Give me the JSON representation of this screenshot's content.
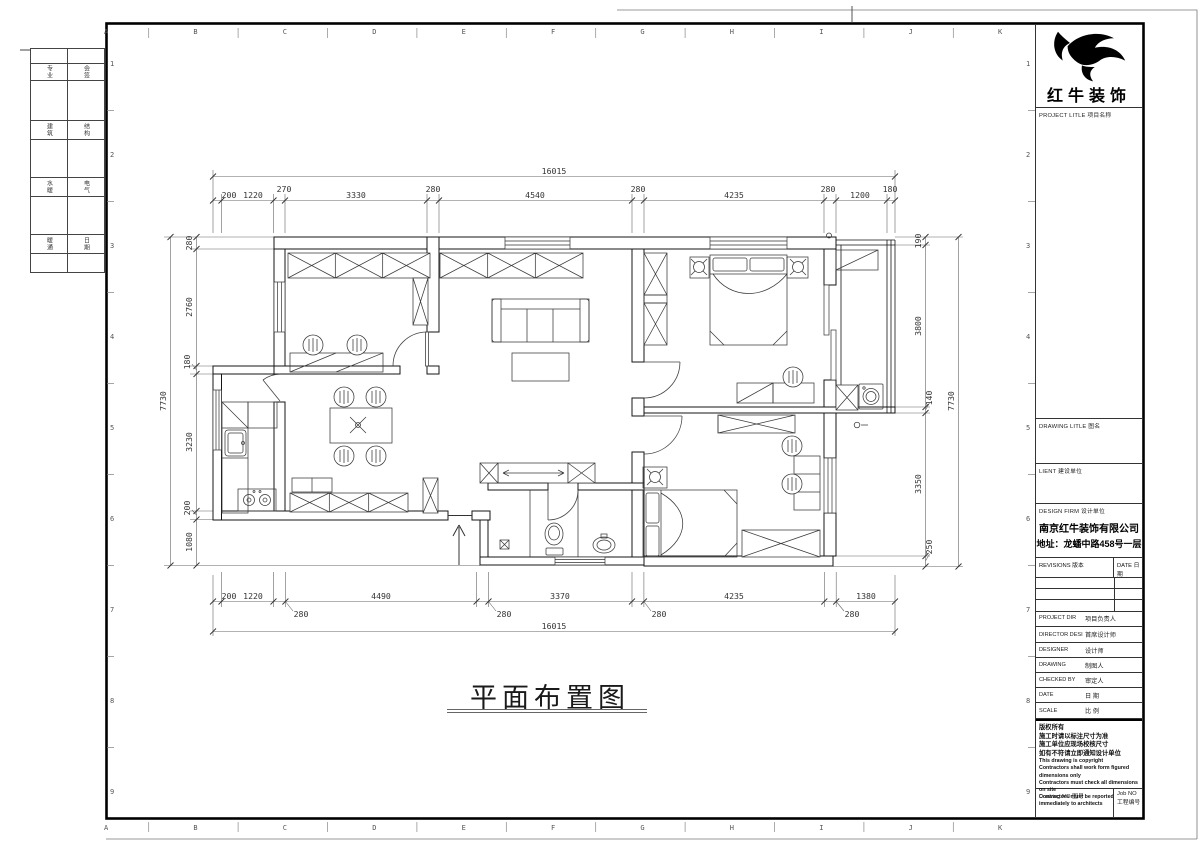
{
  "sheet": {
    "grid_letters": [
      "A",
      "B",
      "C",
      "D",
      "E",
      "F",
      "G",
      "H",
      "I",
      "J",
      "K"
    ],
    "grid_numbers": [
      "1",
      "2",
      "3",
      "4",
      "5",
      "6",
      "7",
      "8",
      "9"
    ],
    "fold_strip": [
      [
        "专业",
        "会签"
      ],
      [
        "建筑",
        "结构"
      ],
      [
        "水暖",
        "电气"
      ],
      [
        "暖通",
        "日期"
      ]
    ]
  },
  "plan": {
    "title": "平面布置图",
    "dims": {
      "top_total": "16015",
      "top": [
        "200",
        "1220",
        "270",
        "3330",
        "280",
        "4540",
        "280",
        "4235",
        "280",
        "1200",
        "180"
      ],
      "bottom": [
        "200",
        "1220",
        "280",
        "4490",
        "280",
        "3370",
        "280",
        "4235",
        "280",
        "1380"
      ],
      "bottom_total": "16015",
      "left": [
        "280",
        "2760",
        "180",
        "3230",
        "200",
        "1080"
      ],
      "left_total": "7730",
      "right": [
        "190",
        "3800",
        "140",
        "3350",
        "250"
      ],
      "right_total": "7730"
    }
  },
  "title_block": {
    "brand": "红牛装饰",
    "project_title": "PROJECT LITLE  项目名称",
    "drawing_title": "DRAWING LITLE  图名",
    "client": "LIENT  建设单位",
    "design_firm": "DESIGN FIRM  设计单位",
    "firm_name": "南京红牛装饰有限公司",
    "firm_address": "地址：龙蟠中路458号一层",
    "revisions": "REVISIONS  版本",
    "date_col": "DATE  日期",
    "rows": [
      {
        "en": "PROJECT DIR",
        "cn": "项目负责人"
      },
      {
        "en": "DIRECTOR DESI",
        "cn": "首席设计师"
      },
      {
        "en": "DESIGNER",
        "cn": "设计师"
      },
      {
        "en": "DRAWING",
        "cn": "制图人"
      },
      {
        "en": "CHECKED BY",
        "cn": "审定人"
      },
      {
        "en": "DATE",
        "cn": "日  期"
      },
      {
        "en": "SCALE",
        "cn": "比  例"
      }
    ],
    "copyright_cn": [
      "版权所有",
      "施工时请以标注尺寸为准",
      "施工单位应现场校核尺寸",
      "如有不符请立即通知设计单位"
    ],
    "copyright_en": [
      "This drawing is copyright",
      "Contractors shall work form figured dimensions only",
      "Contractors must check all dimensions on site",
      "Contractors must be reported immediately to architects"
    ],
    "drawing_no": "Drawing NO  图号",
    "job_no": "Job NO  工程编号"
  }
}
